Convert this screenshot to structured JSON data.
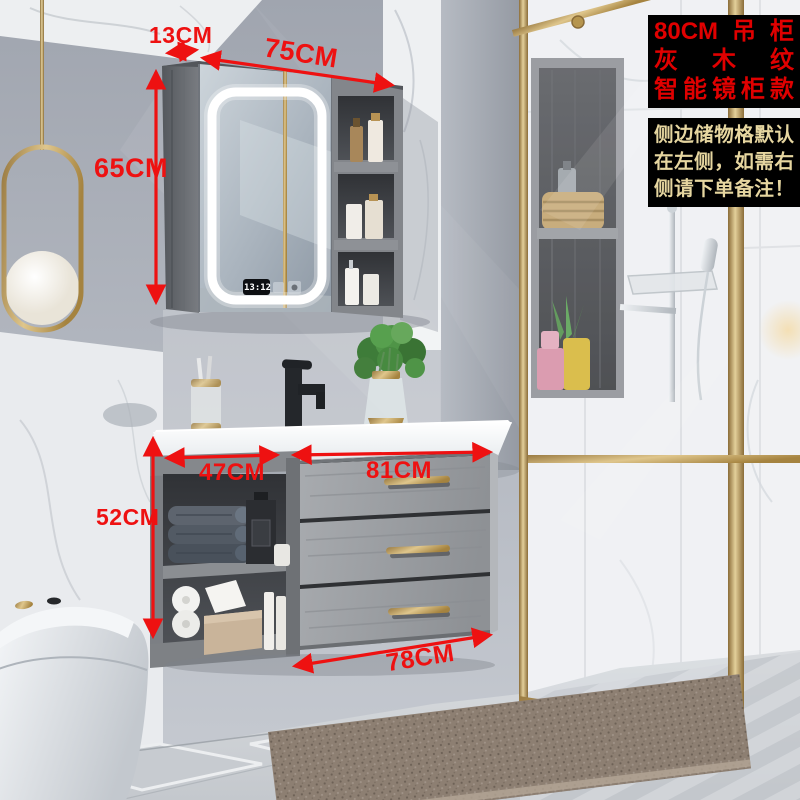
{
  "promo_box_top": {
    "lines": [
      "80CM吊柜",
      "灰木纹",
      "智能镜柜款"
    ],
    "bg_color": "#000000",
    "text_color": "#e00000"
  },
  "promo_box_note": {
    "lines": [
      "侧边储物格默认",
      "在左侧，如需右",
      "侧请下单备注！"
    ],
    "bg_color": "#000000",
    "text_color": "#e6d6a0"
  },
  "dimension_labels": {
    "cabinet_side_depth": "13CM",
    "cabinet_top_width": "75CM",
    "cabinet_height": "65CM",
    "open_shelf_width": "47CM",
    "drawer_section_width": "81CM",
    "vanity_height": "52CM",
    "vanity_bottom_width": "78CM"
  },
  "mirror_clock_time": "13:12",
  "palette": {
    "annotation_red": "#ee1111",
    "brass_gold": "#c3a05e",
    "wall_gray": "#a9aeb8",
    "cabinet_wood_gray": "#95989c",
    "led_white": "#ffffff",
    "shower_tile_white": "#f1f2f4",
    "mat_taupe": "#8d7f72"
  }
}
